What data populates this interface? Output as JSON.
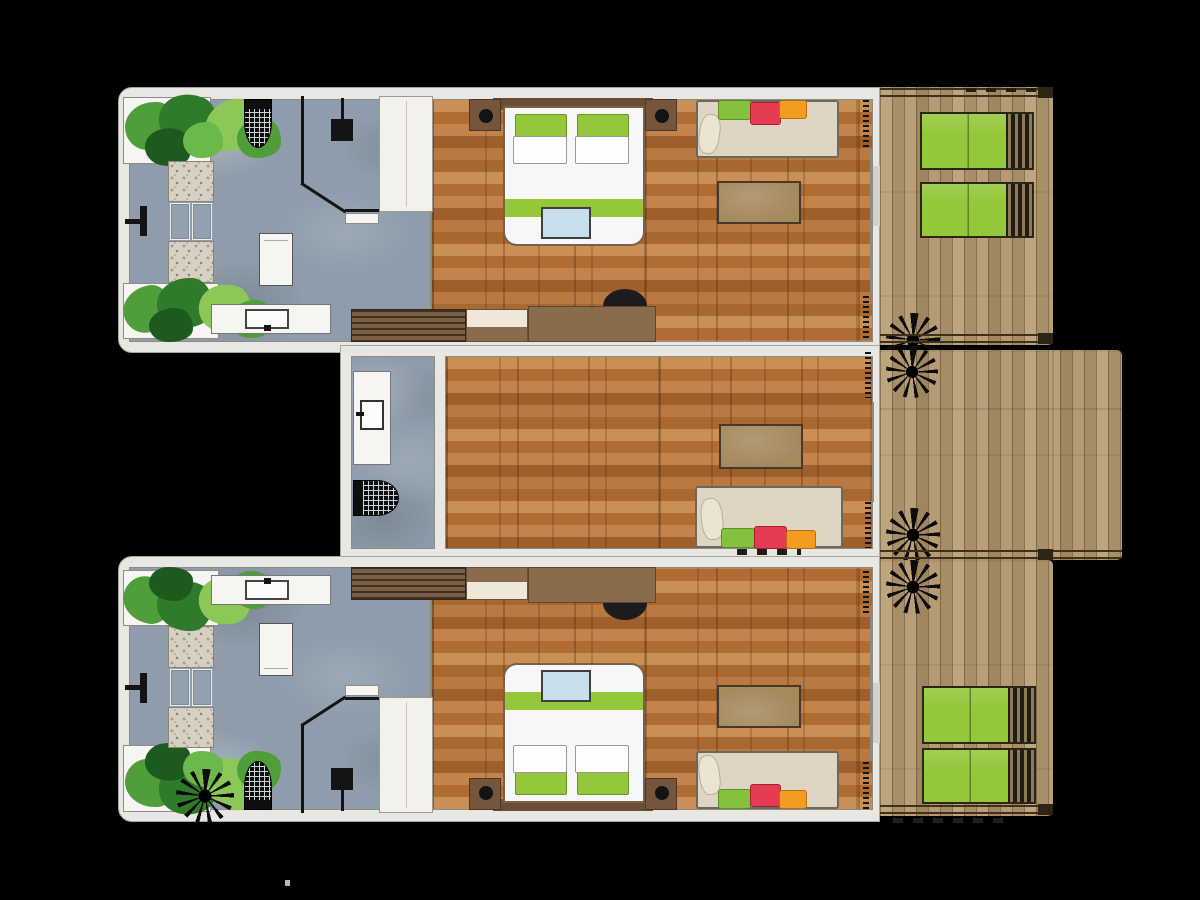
{
  "title": "Resort villa floor plan — three guest units with timber decks",
  "background": "#000000",
  "palette": {
    "wall": "#e9e7e2",
    "wall_line": "#a8a6a0",
    "floor_line": "#8d8b85",
    "wood_base": "#b5763f",
    "wood_light": "#c98f55",
    "wood_mid": "#b06c33",
    "wood_dark": "#9e5f2b",
    "deck_base": "#b29974",
    "deck_grain": "#4a3820",
    "bath_floor": "#8e9cab",
    "pebble": "#d8d0c2",
    "accent_green": "#94c73a",
    "cushion_red": "#e63c52",
    "cushion_orange": "#f49b22",
    "daybed_beige": "#ded6c2",
    "table_wood": "#a68a5e",
    "dark_timber": "#6b4c35",
    "fixture_black": "#141414",
    "tray_blue": "#c9dfec",
    "white_goods": "#f6f5f2",
    "plant_dark": "#2f7a2b",
    "plant_mid": "#4f9e3a",
    "plant_light": "#8cc857"
  },
  "units": [
    {
      "name": "villa-top",
      "areas": [
        "open-air bathroom",
        "bedroom"
      ],
      "furniture": [
        "corner planters with foliage",
        "pebble strips with two bath mats",
        "wall-mounted shower",
        "rain shower",
        "toilet",
        "vanity with basin",
        "entry fixture",
        "angled privacy wall",
        "wardrobe",
        "double bed with two green and two white pillows",
        "green bed runner with blue tray",
        "two bedside tables with lamps",
        "slatted bench",
        "upholstered bench",
        "writing desk",
        "desk chair",
        "daybed with green, red and orange cushions",
        "coffee table",
        "sliding glass door with curtains"
      ]
    },
    {
      "name": "villa-middle",
      "areas": [
        "shower room",
        "lounge"
      ],
      "furniture": [
        "vanity with basin",
        "rain shower",
        "coffee table",
        "daybed with green, red and orange cushions",
        "sliding glass door with curtains"
      ]
    },
    {
      "name": "villa-bottom",
      "areas": [
        "open-air bathroom",
        "bedroom"
      ],
      "furniture": [
        "mirrored copy of villa-top furnishings",
        "extra palm silhouette in bathroom corner"
      ]
    }
  ],
  "decks": [
    {
      "name": "deck-top",
      "features": [
        "two green sun loungers",
        "palm tree",
        "edge rails with end posts"
      ]
    },
    {
      "name": "deck-middle",
      "features": [
        "two palm trees",
        "extended terrace to the right"
      ]
    },
    {
      "name": "deck-bottom",
      "features": [
        "two green sun loungers",
        "palm tree",
        "edge steps below rail"
      ]
    }
  ]
}
